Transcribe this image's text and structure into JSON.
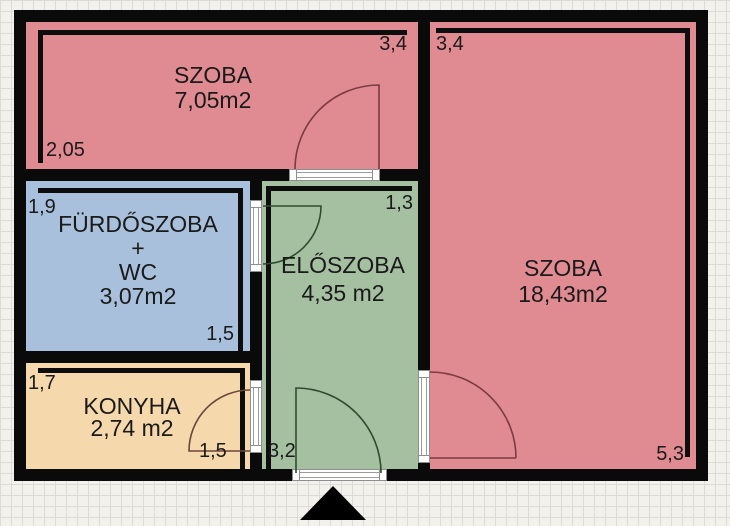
{
  "floorplan": {
    "type": "apartment-floor-plan",
    "wall_color": "#0a0a0a",
    "paper": {
      "background": "#f2f1ec",
      "grid_line_color": "#dcdbd6"
    },
    "rooms": {
      "szoba_small": {
        "name": "SZOBA",
        "area": "7,05m2",
        "fill": "#e08b92"
      },
      "szoba_large": {
        "name": "SZOBA",
        "area": "18,43m2",
        "fill": "#e08b92"
      },
      "furdoszoba": {
        "line1": "FÜRDŐSZOBA",
        "line2": "+",
        "line3": "WC",
        "area": "3,07m2",
        "fill": "#a9c0dd"
      },
      "eloszoba": {
        "name": "ELŐSZOBA",
        "area": "4,35 m2",
        "fill": "#a5c0a1"
      },
      "konyha": {
        "name": "KONYHA",
        "area": "2,74 m2",
        "fill": "#f6d8ad"
      }
    },
    "dimensions": {
      "szoba_small_top": "3,4",
      "szoba_large_top": "3,4",
      "szoba_small_left": "2,05",
      "furdoszoba_top": "1,9",
      "furdoszoba_bottom": "1,5",
      "eloszoba_top": "1,3",
      "konyha_top": "1,7",
      "konyha_bottom": "1,5",
      "eloszoba_bottom": "3,2",
      "szoba_large_bottom": "5,3"
    },
    "door_swing_colors": {
      "on_pink": "#7c3b41",
      "on_green": "#2e4c2e",
      "on_orange": "#6b443c"
    },
    "entrance_marker": {
      "shape": "triangle-up",
      "color": "#000000"
    }
  }
}
